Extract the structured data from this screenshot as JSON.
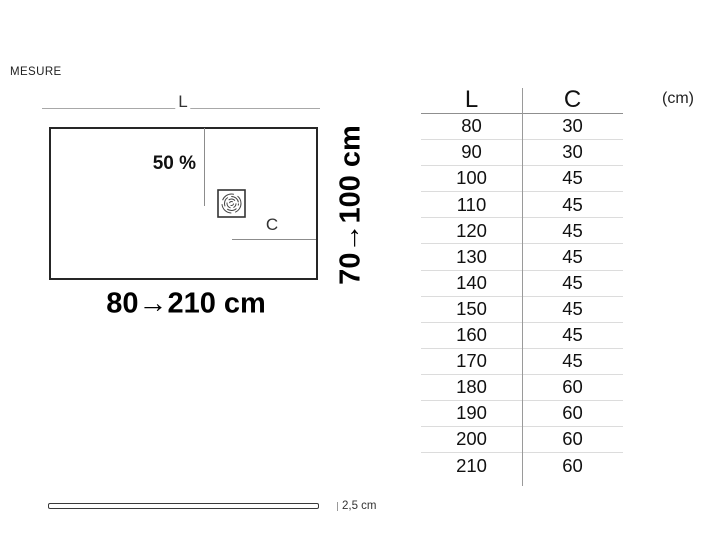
{
  "page": {
    "caption": "MESURE"
  },
  "diagram": {
    "length_dim_label": "L",
    "slope_label": "50 %",
    "drain_outlet_label": "C",
    "width_range_label": "70→100 cm",
    "length_range_label": "80→210 cm"
  },
  "thickness": {
    "label": "2,5 cm"
  },
  "table": {
    "columns": [
      "L",
      "C"
    ],
    "unit_label": "(cm)",
    "rows": [
      [
        "80",
        "30"
      ],
      [
        "90",
        "30"
      ],
      [
        "100",
        "45"
      ],
      [
        "110",
        "45"
      ],
      [
        "120",
        "45"
      ],
      [
        "130",
        "45"
      ],
      [
        "140",
        "45"
      ],
      [
        "150",
        "45"
      ],
      [
        "160",
        "45"
      ],
      [
        "170",
        "45"
      ],
      [
        "180",
        "60"
      ],
      [
        "190",
        "60"
      ],
      [
        "200",
        "60"
      ],
      [
        "210",
        "60"
      ]
    ]
  },
  "colors": {
    "text": "#1a1a1a",
    "outline_strong": "#262626",
    "line_light": "#8c8c8c",
    "row_divider": "#dcdcdc"
  }
}
